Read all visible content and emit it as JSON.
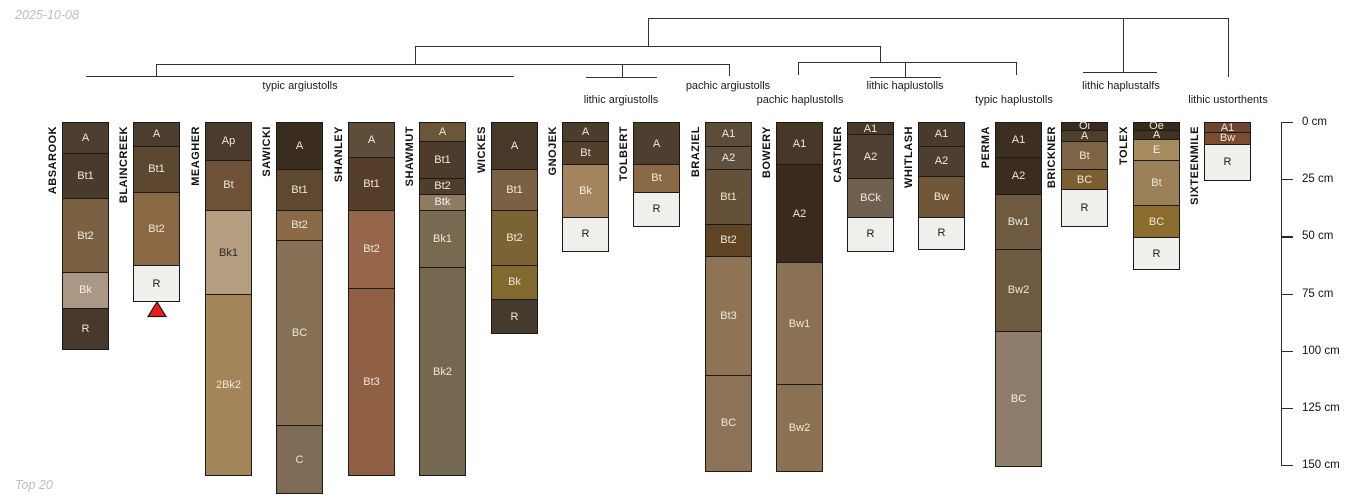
{
  "header": {
    "date": "2025-10-08"
  },
  "footer": {
    "note": "Top 20"
  },
  "chart_data": {
    "type": "soil-profile-dendrogram",
    "depth_axis": {
      "unit": "cm",
      "range": [
        0,
        150
      ],
      "values": [
        0,
        25,
        50,
        75,
        100,
        125,
        150
      ],
      "labels": [
        "0 cm",
        "25 cm",
        "50 cm",
        "75 cm",
        "100 cm",
        "125 cm",
        "150 cm"
      ]
    },
    "cluster_labels": [
      {
        "label": "typic argiustolls",
        "x": 300,
        "y": 80
      },
      {
        "label": "lithic argiustolls",
        "x": 621,
        "y": 94
      },
      {
        "label": "pachic argiustolls",
        "x": 728,
        "y": 80
      },
      {
        "label": "pachic haplustolls",
        "x": 800,
        "y": 94
      },
      {
        "label": "lithic haplustolls",
        "x": 905,
        "y": 80
      },
      {
        "label": "typic haplustolls",
        "x": 1014,
        "y": 94
      },
      {
        "label": "lithic haplustalfs",
        "x": 1121,
        "y": 80
      },
      {
        "label": "lithic ustorthents",
        "x": 1228,
        "y": 94
      }
    ],
    "dendrogram_segments": [
      [
        648,
        18,
        1228,
        18
      ],
      [
        648,
        18,
        648,
        46
      ],
      [
        415,
        46,
        880,
        46
      ],
      [
        415,
        46,
        415,
        64
      ],
      [
        156,
        64,
        729,
        64
      ],
      [
        156,
        64,
        156,
        76
      ],
      [
        86,
        76,
        514,
        76
      ],
      [
        622,
        64,
        622,
        77
      ],
      [
        586,
        77,
        657,
        77
      ],
      [
        729,
        64,
        729,
        76
      ],
      [
        880,
        46,
        880,
        62
      ],
      [
        798,
        62,
        1016,
        62
      ],
      [
        798,
        62,
        798,
        75
      ],
      [
        905,
        62,
        905,
        77
      ],
      [
        870,
        77,
        941,
        77
      ],
      [
        1016,
        62,
        1016,
        75
      ],
      [
        1123,
        18,
        1123,
        72
      ],
      [
        1083,
        72,
        1157,
        72
      ],
      [
        1228,
        18,
        1228,
        77
      ]
    ],
    "marker": {
      "profile": "BLAINCREEK",
      "x": 157,
      "y": 301,
      "color": "#ed1c1c",
      "outline": "#1a1a1a"
    },
    "profile_width": 47,
    "profiles": [
      {
        "name": "ABSAROOK",
        "x": 62,
        "horizons": [
          {
            "name": "A",
            "top": 0,
            "bottom": 13,
            "color": "#4e3e2f",
            "text": "#efe8da"
          },
          {
            "name": "Bt1",
            "top": 13,
            "bottom": 33,
            "color": "#4a3a2b",
            "text": "#efe8da"
          },
          {
            "name": "Bt2",
            "top": 33,
            "bottom": 65,
            "color": "#7b6142",
            "text": "#efe8da"
          },
          {
            "name": "Bk",
            "top": 65,
            "bottom": 81,
            "color": "#ab9884",
            "text": "#f4efe6"
          },
          {
            "name": "R",
            "top": 81,
            "bottom": 99,
            "color": "#46382a",
            "text": "#efe8da"
          }
        ]
      },
      {
        "name": "BLAINCREEK",
        "x": 133,
        "horizons": [
          {
            "name": "A",
            "top": 0,
            "bottom": 10,
            "color": "#4d3d2e",
            "text": "#efe8da"
          },
          {
            "name": "Bt1",
            "top": 10,
            "bottom": 30,
            "color": "#5d4731",
            "text": "#efe8da"
          },
          {
            "name": "Bt2",
            "top": 30,
            "bottom": 62,
            "color": "#8a6843",
            "text": "#efe8da"
          },
          {
            "name": "R",
            "top": 62,
            "bottom": 78,
            "color": "#efefec",
            "text": "#1a1a1a"
          }
        ]
      },
      {
        "name": "MEAGHER",
        "x": 205,
        "horizons": [
          {
            "name": "Ap",
            "top": 0,
            "bottom": 16,
            "color": "#4a3b2c",
            "text": "#efe8da"
          },
          {
            "name": "Bt",
            "top": 16,
            "bottom": 38,
            "color": "#6d5238",
            "text": "#efe8da"
          },
          {
            "name": "Bk1",
            "top": 38,
            "bottom": 75,
            "color": "#b59d80",
            "text": "#2a2a2a"
          },
          {
            "name": "2Bk2",
            "top": 75,
            "bottom": 154,
            "color": "#a28559",
            "text": "#efe8da"
          }
        ]
      },
      {
        "name": "SAWICKI",
        "x": 276,
        "horizons": [
          {
            "name": "A",
            "top": 0,
            "bottom": 20,
            "color": "#3b2d1e",
            "text": "#efe8da"
          },
          {
            "name": "Bt1",
            "top": 20,
            "bottom": 38,
            "color": "#5f4830",
            "text": "#efe8da"
          },
          {
            "name": "Bt2",
            "top": 38,
            "bottom": 51,
            "color": "#8a6a47",
            "text": "#efe8da"
          },
          {
            "name": "BC",
            "top": 51,
            "bottom": 132,
            "color": "#867157",
            "text": "#efe8da"
          },
          {
            "name": "C",
            "top": 132,
            "bottom": 162,
            "color": "#7d6b55",
            "text": "#efe8da"
          }
        ]
      },
      {
        "name": "SHANLEY",
        "x": 348,
        "horizons": [
          {
            "name": "A",
            "top": 0,
            "bottom": 15,
            "color": "#5e4d39",
            "text": "#efe8da"
          },
          {
            "name": "Bt1",
            "top": 15,
            "bottom": 38,
            "color": "#553f2b",
            "text": "#efe8da"
          },
          {
            "name": "Bt2",
            "top": 38,
            "bottom": 72,
            "color": "#95664a",
            "text": "#efe8da"
          },
          {
            "name": "Bt3",
            "top": 72,
            "bottom": 154,
            "color": "#8f6044",
            "text": "#efe8da"
          }
        ]
      },
      {
        "name": "SHAWMUT",
        "x": 419,
        "horizons": [
          {
            "name": "A",
            "top": 0,
            "bottom": 8,
            "color": "#6a5639",
            "text": "#efe8da"
          },
          {
            "name": "Bt1",
            "top": 8,
            "bottom": 24,
            "color": "#4d3c2c",
            "text": "#efe8da"
          },
          {
            "name": "Bt2",
            "top": 24,
            "bottom": 31,
            "color": "#503e2d",
            "text": "#efe8da"
          },
          {
            "name": "Btk",
            "top": 31,
            "bottom": 38,
            "color": "#8e7b63",
            "text": "#f4efe6"
          },
          {
            "name": "Bk1",
            "top": 38,
            "bottom": 63,
            "color": "#786a50",
            "text": "#efe8da"
          },
          {
            "name": "Bk2",
            "top": 63,
            "bottom": 154,
            "color": "#746850",
            "text": "#efe8da"
          }
        ]
      },
      {
        "name": "WICKES",
        "x": 491,
        "horizons": [
          {
            "name": "A",
            "top": 0,
            "bottom": 20,
            "color": "#483828",
            "text": "#efe8da"
          },
          {
            "name": "Bt1",
            "top": 20,
            "bottom": 38,
            "color": "#7a6143",
            "text": "#efe8da"
          },
          {
            "name": "Bt2",
            "top": 38,
            "bottom": 62,
            "color": "#7a6335",
            "text": "#efe8da"
          },
          {
            "name": "Bk",
            "top": 62,
            "bottom": 77,
            "color": "#82692e",
            "text": "#efe8da"
          },
          {
            "name": "R",
            "top": 77,
            "bottom": 92,
            "color": "#473b2f",
            "text": "#efe8da"
          }
        ]
      },
      {
        "name": "GNOJEK",
        "x": 562,
        "horizons": [
          {
            "name": "A",
            "top": 0,
            "bottom": 8,
            "color": "#4c3c2c",
            "text": "#efe8da"
          },
          {
            "name": "Bt",
            "top": 8,
            "bottom": 18,
            "color": "#533f2b",
            "text": "#efe8da"
          },
          {
            "name": "Bk",
            "top": 18,
            "bottom": 41,
            "color": "#a2855f",
            "text": "#f4efe6"
          },
          {
            "name": "R",
            "top": 41,
            "bottom": 56,
            "color": "#efefec",
            "text": "#1a1a1a"
          }
        ]
      },
      {
        "name": "TOLBERT",
        "x": 633,
        "horizons": [
          {
            "name": "A",
            "top": 0,
            "bottom": 18,
            "color": "#4e3e2d",
            "text": "#efe8da"
          },
          {
            "name": "Bt",
            "top": 18,
            "bottom": 30,
            "color": "#8a6a46",
            "text": "#efe8da"
          },
          {
            "name": "R",
            "top": 30,
            "bottom": 45,
            "color": "#efefec",
            "text": "#1a1a1a"
          }
        ]
      },
      {
        "name": "BRAZIEL",
        "x": 705,
        "horizons": [
          {
            "name": "A1",
            "top": 0,
            "bottom": 10,
            "color": "#5c4c3a",
            "text": "#efe8da"
          },
          {
            "name": "A2",
            "top": 10,
            "bottom": 20,
            "color": "#60513f",
            "text": "#efe8da"
          },
          {
            "name": "Bt1",
            "top": 20,
            "bottom": 44,
            "color": "#645138",
            "text": "#efe8da"
          },
          {
            "name": "Bt2",
            "top": 44,
            "bottom": 58,
            "color": "#5f4325",
            "text": "#efe8da"
          },
          {
            "name": "Bt3",
            "top": 58,
            "bottom": 110,
            "color": "#8e7355",
            "text": "#efe8da"
          },
          {
            "name": "BC",
            "top": 110,
            "bottom": 152,
            "color": "#8c7256",
            "text": "#efe8da"
          }
        ]
      },
      {
        "name": "BOWERY",
        "x": 776,
        "horizons": [
          {
            "name": "A1",
            "top": 0,
            "bottom": 18,
            "color": "#463727",
            "text": "#efe8da"
          },
          {
            "name": "A2",
            "top": 18,
            "bottom": 61,
            "color": "#392a1c",
            "text": "#efe8da"
          },
          {
            "name": "Bw1",
            "top": 61,
            "bottom": 114,
            "color": "#8a7154",
            "text": "#efe8da"
          },
          {
            "name": "Bw2",
            "top": 114,
            "bottom": 152,
            "color": "#8a7152",
            "text": "#efe8da"
          }
        ]
      },
      {
        "name": "CASTNER",
        "x": 847,
        "horizons": [
          {
            "name": "A1",
            "top": 0,
            "bottom": 5,
            "color": "#49392a",
            "text": "#efe8da"
          },
          {
            "name": "A2",
            "top": 5,
            "bottom": 24,
            "color": "#4f4031",
            "text": "#efe8da"
          },
          {
            "name": "BCk",
            "top": 24,
            "bottom": 41,
            "color": "#6f6050",
            "text": "#efe8da"
          },
          {
            "name": "R",
            "top": 41,
            "bottom": 56,
            "color": "#efefec",
            "text": "#1a1a1a"
          }
        ]
      },
      {
        "name": "WHITLASH",
        "x": 918,
        "horizons": [
          {
            "name": "A1",
            "top": 0,
            "bottom": 10,
            "color": "#4a3a2b",
            "text": "#efe8da"
          },
          {
            "name": "A2",
            "top": 10,
            "bottom": 23,
            "color": "#4e3e2f",
            "text": "#efe8da"
          },
          {
            "name": "Bw",
            "top": 23,
            "bottom": 41,
            "color": "#6f5637",
            "text": "#efe8da"
          },
          {
            "name": "R",
            "top": 41,
            "bottom": 55,
            "color": "#efefec",
            "text": "#1a1a1a"
          }
        ]
      },
      {
        "name": "PERMA",
        "x": 995,
        "horizons": [
          {
            "name": "A1",
            "top": 0,
            "bottom": 15,
            "color": "#3d2f20",
            "text": "#efe8da"
          },
          {
            "name": "A2",
            "top": 15,
            "bottom": 31,
            "color": "#3a2c1e",
            "text": "#efe8da"
          },
          {
            "name": "Bw1",
            "top": 31,
            "bottom": 55,
            "color": "#6f5a41",
            "text": "#efe8da"
          },
          {
            "name": "Bw2",
            "top": 55,
            "bottom": 91,
            "color": "#6e5941",
            "text": "#efe8da"
          },
          {
            "name": "BC",
            "top": 91,
            "bottom": 150,
            "color": "#8e7d6a",
            "text": "#f4efe6"
          }
        ]
      },
      {
        "name": "BRICKNER",
        "x": 1061,
        "horizons": [
          {
            "name": "Oi",
            "top": 0,
            "bottom": 3,
            "color": "#3a2d1f",
            "text": "#efe8da"
          },
          {
            "name": "A",
            "top": 3,
            "bottom": 8,
            "color": "#503f2d",
            "text": "#efe8da"
          },
          {
            "name": "Bt",
            "top": 8,
            "bottom": 20,
            "color": "#7c6445",
            "text": "#efe8da"
          },
          {
            "name": "BC",
            "top": 20,
            "bottom": 29,
            "color": "#7c5e31",
            "text": "#efe8da"
          },
          {
            "name": "R",
            "top": 29,
            "bottom": 45,
            "color": "#efefec",
            "text": "#1a1a1a"
          }
        ]
      },
      {
        "name": "TOLEX",
        "x": 1133,
        "horizons": [
          {
            "name": "Oe",
            "top": 0,
            "bottom": 3,
            "color": "#362a1b",
            "text": "#efe8da"
          },
          {
            "name": "A",
            "top": 3,
            "bottom": 7,
            "color": "#413320",
            "text": "#efe8da"
          },
          {
            "name": "E",
            "top": 7,
            "bottom": 16,
            "color": "#a78b5f",
            "text": "#f4efe6"
          },
          {
            "name": "Bt",
            "top": 16,
            "bottom": 36,
            "color": "#9a8159",
            "text": "#efe8da"
          },
          {
            "name": "BC",
            "top": 36,
            "bottom": 50,
            "color": "#8d6d2e",
            "text": "#efe8da"
          },
          {
            "name": "R",
            "top": 50,
            "bottom": 64,
            "color": "#efefec",
            "text": "#1a1a1a"
          }
        ]
      },
      {
        "name": "SIXTEENMILE",
        "x": 1204,
        "horizons": [
          {
            "name": "A1",
            "top": 0,
            "bottom": 4,
            "color": "#6d4530",
            "text": "#efe8da"
          },
          {
            "name": "Bw",
            "top": 4,
            "bottom": 9,
            "color": "#7b4b32",
            "text": "#efe8da"
          },
          {
            "name": "R",
            "top": 9,
            "bottom": 25,
            "color": "#efefec",
            "text": "#1a1a1a"
          }
        ]
      }
    ]
  }
}
